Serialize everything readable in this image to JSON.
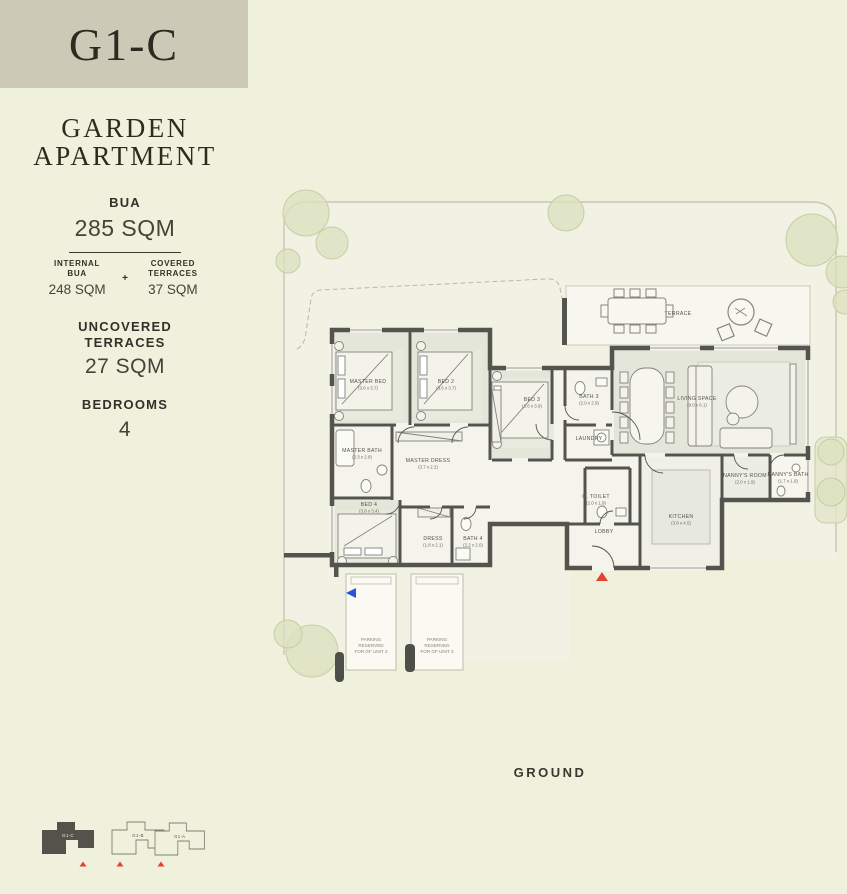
{
  "page": {
    "floor_label": "GROUND"
  },
  "sidebar": {
    "unit_code": "G1-C",
    "title": {
      "line1": "GARDEN",
      "line2": "APARTMENT"
    },
    "bua": {
      "label": "BUA",
      "value": "285 SQM"
    },
    "internal": {
      "label1": "INTERNAL",
      "label2": "BUA",
      "value": "248 SQM"
    },
    "plus": "+",
    "covered": {
      "label1": "COVERED",
      "label2": "TERRACES",
      "value": "37 SQM"
    },
    "uncovered": {
      "label1": "UNCOVERED",
      "label2": "TERRACES",
      "value": "27 SQM"
    },
    "bedrooms": {
      "label": "BEDROOMS",
      "value": "4"
    },
    "keyplan": {
      "units": [
        {
          "label": "G1-C",
          "selected": true
        },
        {
          "label": "G1-B",
          "selected": false
        },
        {
          "label": "G1-A",
          "selected": false
        }
      ]
    }
  },
  "plan": {
    "rooms": [
      {
        "name": "MASTER BED",
        "dims": "(3.6 x 3.7)"
      },
      {
        "name": "BED 2",
        "dims": "(3.6 x 3.7)"
      },
      {
        "name": "BED 3",
        "dims": "(3.6 x 3.9)"
      },
      {
        "name": "BATH 3",
        "dims": "(2.0 x 2.9)"
      },
      {
        "name": "LAUNDRY",
        "dims": ""
      },
      {
        "name": "MASTER BATH",
        "dims": "(2.3 x 2.8)"
      },
      {
        "name": "MASTER DRESS",
        "dims": "(3.7 x 2.2)"
      },
      {
        "name": "BED 4",
        "dims": "(3.8 x 3.4)"
      },
      {
        "name": "DRESS",
        "dims": "(1.8 x 2.1)"
      },
      {
        "name": "BATH 4",
        "dims": "(2.2 x 2.0)"
      },
      {
        "name": "LIVING SPACE",
        "dims": "(9.0 x 6.1)"
      },
      {
        "name": "KITCHEN",
        "dims": "(3.8 x 4.5)"
      },
      {
        "name": "NANNY'S ROOM",
        "dims": "(2.0 x 1.9)"
      },
      {
        "name": "NANNY'S BATH",
        "dims": "(1.7 x 1.9)"
      },
      {
        "name": "G. TOILET",
        "dims": "(2.0 x 1.9)"
      },
      {
        "name": "LOBBY",
        "dims": ""
      },
      {
        "name": "TERRACE",
        "dims": ""
      }
    ],
    "parking": {
      "line1": "PARKING",
      "line2": "RESERVED",
      "line3": "FOR GF UNIT 3"
    }
  },
  "colors": {
    "page_bg": "#f0f1dc",
    "header_bg": "#cdc9b7",
    "wall": "#54544e",
    "accent_red": "#e8402f",
    "tree_green": "#dde1c0",
    "marker_blue": "#2b55d8"
  }
}
